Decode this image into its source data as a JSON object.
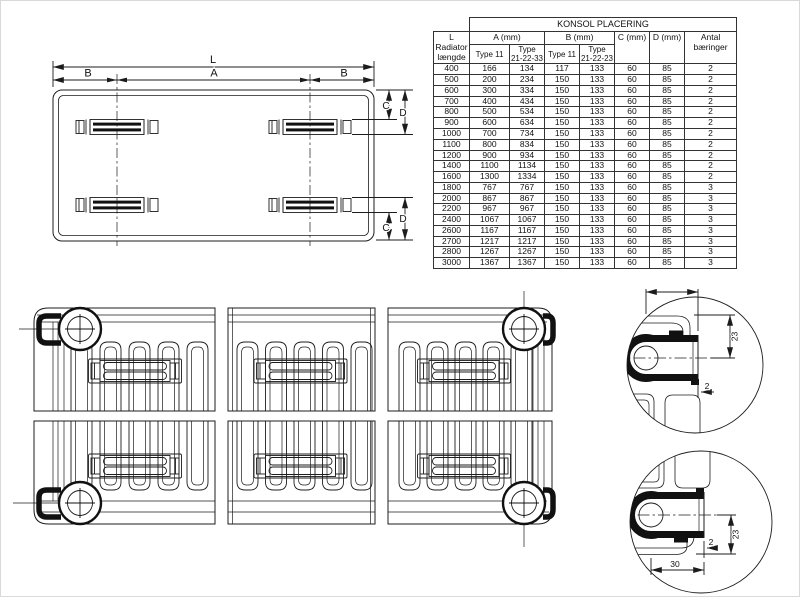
{
  "style": {
    "background": "#ffffff",
    "line_color": "#1c1c1c",
    "fill_black": "#111111"
  },
  "plan": {
    "label_l": "L",
    "label_a": "A",
    "label_b_left": "B",
    "label_b_right": "B",
    "label_c_top": "C",
    "label_d_top": "D",
    "label_c_bottom": "C",
    "label_d_bottom": "D"
  },
  "table": {
    "title": "KONSOL PLACERING",
    "headers": {
      "length": "L\nRadiator\nlængde",
      "a": "A (mm)",
      "b": "B (mm)",
      "c": "C (mm)",
      "d": "D (mm)",
      "count": "Antal\nbæringer",
      "a_type11": "Type 11",
      "a_type213233": "Type\n21-22-33",
      "b_type11": "Type 11",
      "b_type212223": "Type\n21-22-23"
    },
    "rows": [
      [
        "400",
        "166",
        "134",
        "117",
        "133",
        "60",
        "85",
        "2"
      ],
      [
        "500",
        "200",
        "234",
        "150",
        "133",
        "60",
        "85",
        "2"
      ],
      [
        "600",
        "300",
        "334",
        "150",
        "133",
        "60",
        "85",
        "2"
      ],
      [
        "700",
        "400",
        "434",
        "150",
        "133",
        "60",
        "85",
        "2"
      ],
      [
        "800",
        "500",
        "534",
        "150",
        "133",
        "60",
        "85",
        "2"
      ],
      [
        "900",
        "600",
        "634",
        "150",
        "133",
        "60",
        "85",
        "2"
      ],
      [
        "1000",
        "700",
        "734",
        "150",
        "133",
        "60",
        "85",
        "2"
      ],
      [
        "1100",
        "800",
        "834",
        "150",
        "133",
        "60",
        "85",
        "2"
      ],
      [
        "1200",
        "900",
        "934",
        "150",
        "133",
        "60",
        "85",
        "2"
      ],
      [
        "1400",
        "1100",
        "1134",
        "150",
        "133",
        "60",
        "85",
        "2"
      ],
      [
        "1600",
        "1300",
        "1334",
        "150",
        "133",
        "60",
        "85",
        "2"
      ],
      [
        "1800",
        "767",
        "767",
        "150",
        "133",
        "60",
        "85",
        "3"
      ],
      [
        "2000",
        "867",
        "867",
        "150",
        "133",
        "60",
        "85",
        "3"
      ],
      [
        "2200",
        "967",
        "967",
        "150",
        "133",
        "60",
        "85",
        "3"
      ],
      [
        "2400",
        "1067",
        "1067",
        "150",
        "133",
        "60",
        "85",
        "3"
      ],
      [
        "2600",
        "1167",
        "1167",
        "150",
        "133",
        "60",
        "85",
        "3"
      ],
      [
        "2700",
        "1217",
        "1217",
        "150",
        "133",
        "60",
        "85",
        "3"
      ],
      [
        "2800",
        "1267",
        "1267",
        "150",
        "133",
        "60",
        "85",
        "3"
      ],
      [
        "3000",
        "1367",
        "1367",
        "150",
        "133",
        "60",
        "85",
        "3"
      ]
    ]
  },
  "details": {
    "top": {
      "width": "30",
      "height": "23",
      "offset": "2"
    },
    "bottom": {
      "width": "30",
      "height": "23",
      "offset": "2"
    }
  }
}
